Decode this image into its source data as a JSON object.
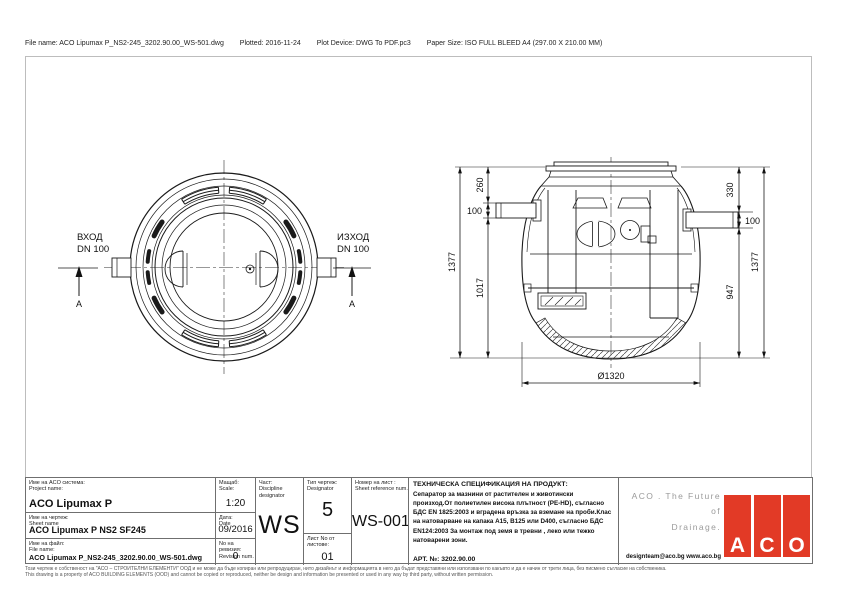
{
  "header": {
    "file": "File name: ACO Lipumax P_NS2-245_3202.90.00_WS-501.dwg",
    "plotted": "Plotted: 2016-11-24",
    "device": "Plot Device: DWG To PDF.pc3",
    "paper": "Paper Size: ISO FULL BLEED A4 (297.00 X 210.00 MM)"
  },
  "top_view": {
    "inlet_title": "ВХОД",
    "inlet_size": "DN 100",
    "outlet_title": "ИЗХОД",
    "outlet_size": "DN 100",
    "section_marker": "A"
  },
  "section_dims": {
    "total_left": "1377",
    "seg_260": "260",
    "inlet_dn": "100",
    "seg_1017": "1017",
    "seg_330": "330",
    "outlet_dn": "100",
    "seg_947": "947",
    "total_right": "1377",
    "diameter": "Ø1320"
  },
  "title_block": {
    "project": {
      "label_bg": "Име на ACO система:",
      "label_en": "Project name:",
      "value": "ACO Lipumax P"
    },
    "scale": {
      "label_bg": "Мащаб:",
      "label_en": "Scale:",
      "value": "1:20"
    },
    "sheet_name": {
      "label_bg": "Име на чертеж:",
      "label_en": "Sheet name",
      "value": "ACO Lipumax P NS2 SF245"
    },
    "date": {
      "label_bg": "Дата:",
      "label_en": "Date",
      "value": "09/2016"
    },
    "file": {
      "label_bg": "Име на файл:",
      "label_en": "File name:",
      "value": "ACO Lipumax P_NS2-245_3202.90.00_WS-501.dwg"
    },
    "revision": {
      "label_bg": "No на ревизия:",
      "label_en": "Revision num.",
      "value": "0"
    },
    "discipline": {
      "label_bg": "Част:",
      "label_en": "Discipline designator",
      "value": "WS"
    },
    "type": {
      "label_bg": "Тип чертеж:",
      "label_en": "Designator",
      "value": "5"
    },
    "sheets": {
      "label": "Лист No от листове:",
      "value": "01"
    },
    "sheet_ref": {
      "label_bg": "Номер на лист :",
      "label_en": "Sheet reference num.",
      "value": "WS-001"
    },
    "spec": {
      "title": "ТЕХНИЧЕСКА СПЕЦИФИКАЦИЯ НА ПРОДУКТ:",
      "body": "Сепаратор за мазнини от растителен и животински произход.От полиетилен висока плътност (PE-HD), съгласно БДС EN 1825:2003 и вградена връзка за вземане на проби.Клас на натоварване на капака A15, B125 или D400, съгласно БДС EN124:2003 За монтаж под земя в тревни , леко или тежко натоварени зони.",
      "art": "АРТ. №: 3202.90.00"
    },
    "brand": {
      "slogan1": "ACO . The Future of",
      "slogan2": "Drainage.",
      "contacts": "designteam@aco.bg  www.aco.bg",
      "letters": [
        "A",
        "C",
        "O"
      ],
      "logo_color": "#e23a26"
    }
  },
  "footer": {
    "line_bg": "Този чертеж е собственост на \"АСО – СТРОИТЕЛНИ ЕЛЕМЕНТИ\" ООД и не може да бъде копиран или репродуциран, нито дизайнът и информацията в него да бъдат представяни или използвани по какъвто и да е начин от трети лица, без писмено съгласие на собственика.",
    "line_en": "This drawing is a property of ACO BUILDING ELEMENTS (OOD) and cannot be copied or reproduced, neither be design and information be presented or used in any way by third party, without written permission."
  }
}
